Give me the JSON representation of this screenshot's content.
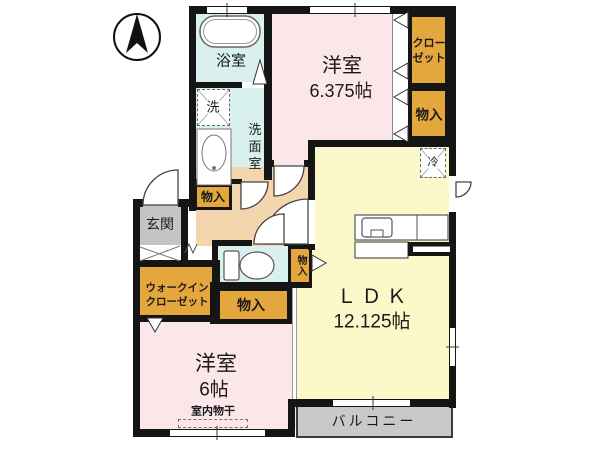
{
  "floorplan": {
    "compass": "north-up",
    "rooms": {
      "bedroom_top": {
        "name": "洋室",
        "size": "6.375帖"
      },
      "bedroom_bottom": {
        "name": "洋室",
        "size": "6帖",
        "indoor_drying": "室内物干"
      },
      "ldk": {
        "name": "ＬＤＫ",
        "size": "12.125帖"
      },
      "bath": {
        "name": "浴室"
      },
      "washroom": {
        "name": "洗面室"
      },
      "entrance": {
        "name": "玄関"
      },
      "balcony": {
        "name": "バルコニー"
      }
    },
    "storage": {
      "closet": {
        "line1": "クロー",
        "line2": "ゼット"
      },
      "walk_in_closet": {
        "line1": "ウォークイン",
        "line2": "クローゼット"
      },
      "monoiri": "物入"
    },
    "appliances": {
      "washer": "洗",
      "fridge": "冷"
    },
    "colors": {
      "room_pink": "#fbe6ea",
      "ldk_yellow": "#fbf9c9",
      "wet_cyan": "#d8f1ef",
      "storage_orange": "#e4a73e",
      "hall_beige": "#f3d6ae",
      "entrance_gray": "#c4c4c4",
      "balcony_gray": "#c9c9c9",
      "wall": "#151515"
    }
  }
}
